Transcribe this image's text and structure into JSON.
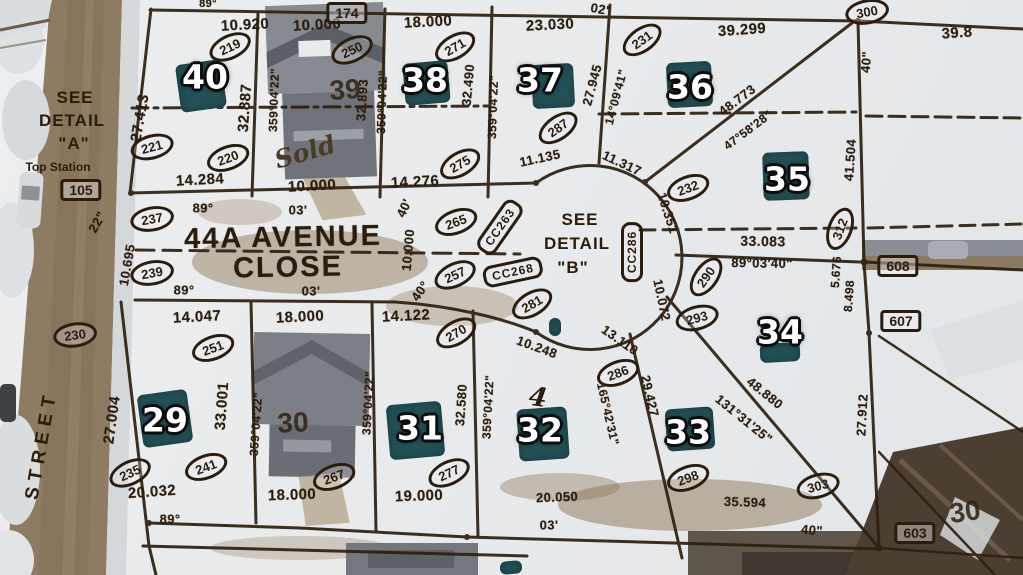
{
  "map_type": "aerial-survey-plat-overlay",
  "ink_color": "#2b1c0c",
  "teal_color": "#235156",
  "street": {
    "main_line1": "44A AVENUE",
    "main_line2": "CLOSE",
    "side_street": "STREET"
  },
  "notes": {
    "detail_a": [
      "SEE",
      "DETAIL",
      "\"A\""
    ],
    "detail_a_sub": "Top Station",
    "detail_b": [
      "SEE",
      "DETAIL",
      "\"B\""
    ],
    "sold": "Sold",
    "pen_mark": "4"
  },
  "lots": {
    "badges": [
      {
        "t": "40",
        "x": 205,
        "y": 77
      },
      {
        "t": "38",
        "x": 425,
        "y": 80
      },
      {
        "t": "37",
        "x": 540,
        "y": 80
      },
      {
        "t": "36",
        "x": 690,
        "y": 87
      },
      {
        "t": "35",
        "x": 787,
        "y": 179
      },
      {
        "t": "34",
        "x": 780,
        "y": 332
      },
      {
        "t": "33",
        "x": 688,
        "y": 432
      },
      {
        "t": "32",
        "x": 540,
        "y": 430
      },
      {
        "t": "31",
        "x": 420,
        "y": 428
      },
      {
        "t": "29",
        "x": 165,
        "y": 420
      }
    ],
    "roof_numbers": [
      {
        "t": "39",
        "x": 345,
        "y": 90,
        "r": -4
      },
      {
        "t": "30",
        "x": 293,
        "y": 423,
        "r": -3
      },
      {
        "t": "30",
        "x": 965,
        "y": 512,
        "r": -8
      }
    ],
    "teal_patches": [
      {
        "x": 178,
        "y": 62,
        "w": 46,
        "h": 48,
        "r": -8
      },
      {
        "x": 404,
        "y": 62,
        "w": 45,
        "h": 42,
        "r": -5
      },
      {
        "x": 532,
        "y": 64,
        "w": 42,
        "h": 44,
        "r": -3
      },
      {
        "x": 667,
        "y": 62,
        "w": 45,
        "h": 45,
        "r": -3
      },
      {
        "x": 763,
        "y": 152,
        "w": 46,
        "h": 48,
        "r": -2
      },
      {
        "x": 760,
        "y": 343,
        "w": 40,
        "h": 19,
        "r": -3
      },
      {
        "x": 666,
        "y": 408,
        "w": 48,
        "h": 42,
        "r": -4
      },
      {
        "x": 518,
        "y": 408,
        "w": 50,
        "h": 52,
        "r": -4
      },
      {
        "x": 388,
        "y": 403,
        "w": 55,
        "h": 55,
        "r": -5
      },
      {
        "x": 140,
        "y": 392,
        "w": 50,
        "h": 53,
        "r": -8
      },
      {
        "x": 549,
        "y": 318,
        "w": 12,
        "h": 18,
        "r": 0
      },
      {
        "x": 500,
        "y": 561,
        "w": 22,
        "h": 13,
        "r": -5
      }
    ]
  },
  "annotations": {
    "dimensions": [
      {
        "t": "89°",
        "x": 208,
        "y": 4,
        "s": 11
      },
      {
        "t": "10.920",
        "x": 245,
        "y": 25,
        "r": -3
      },
      {
        "t": "10.000",
        "x": 317,
        "y": 25,
        "r": -3
      },
      {
        "t": "18.000",
        "x": 428,
        "y": 22,
        "r": -3
      },
      {
        "t": "23.030",
        "x": 550,
        "y": 25,
        "r": -3
      },
      {
        "t": "02'",
        "x": 600,
        "y": 9,
        "r": 10,
        "s": 13
      },
      {
        "t": "39.299",
        "x": 742,
        "y": 30,
        "r": -4
      },
      {
        "t": "39.8",
        "x": 957,
        "y": 33,
        "r": -4
      },
      {
        "t": "27.413",
        "x": 140,
        "y": 118,
        "r": -80
      },
      {
        "t": "32.887",
        "x": 245,
        "y": 108,
        "r": -86
      },
      {
        "t": "359°04'22\"",
        "x": 274,
        "y": 100,
        "r": -88,
        "s": 12
      },
      {
        "t": "32.893",
        "x": 362,
        "y": 100,
        "r": -86,
        "s": 13
      },
      {
        "t": "359°04'22\"",
        "x": 382,
        "y": 102,
        "r": -88,
        "s": 12
      },
      {
        "t": "32.490",
        "x": 468,
        "y": 85,
        "r": -85,
        "s": 13
      },
      {
        "t": "359°04'22\"",
        "x": 493,
        "y": 107,
        "r": -88,
        "s": 12
      },
      {
        "t": "27.945",
        "x": 592,
        "y": 85,
        "r": -75,
        "s": 13
      },
      {
        "t": "14°09'41\"",
        "x": 616,
        "y": 97,
        "r": -75,
        "s": 12
      },
      {
        "t": "48.773",
        "x": 737,
        "y": 100,
        "r": -37,
        "s": 13
      },
      {
        "t": "47°58'28\"",
        "x": 748,
        "y": 130,
        "r": -37,
        "s": 12
      },
      {
        "t": "40\"",
        "x": 866,
        "y": 62,
        "r": -85,
        "s": 13
      },
      {
        "t": "41.504",
        "x": 850,
        "y": 160,
        "r": -86,
        "s": 13
      },
      {
        "t": "11.135",
        "x": 540,
        "y": 158,
        "r": -12,
        "s": 13
      },
      {
        "t": "11.317",
        "x": 622,
        "y": 163,
        "r": 25,
        "s": 13
      },
      {
        "t": "14.284",
        "x": 200,
        "y": 180,
        "r": -3
      },
      {
        "t": "10.000",
        "x": 312,
        "y": 186,
        "r": -3
      },
      {
        "t": "14.276",
        "x": 415,
        "y": 182,
        "r": -3
      },
      {
        "t": "89°",
        "x": 203,
        "y": 208,
        "s": 13
      },
      {
        "t": "03'",
        "x": 298,
        "y": 210,
        "s": 13
      },
      {
        "t": "40'",
        "x": 404,
        "y": 208,
        "r": -65,
        "s": 13
      },
      {
        "t": "10.000",
        "x": 408,
        "y": 250,
        "r": -85,
        "s": 13
      },
      {
        "t": "40°",
        "x": 420,
        "y": 291,
        "r": -55,
        "s": 13
      },
      {
        "t": "89°",
        "x": 184,
        "y": 290,
        "s": 13
      },
      {
        "t": "03'",
        "x": 311,
        "y": 291,
        "s": 13
      },
      {
        "t": "10.695",
        "x": 127,
        "y": 265,
        "r": -80,
        "s": 13
      },
      {
        "t": "22\"",
        "x": 97,
        "y": 222,
        "r": -60,
        "s": 13
      },
      {
        "t": "10.351",
        "x": 668,
        "y": 213,
        "r": 72,
        "s": 13
      },
      {
        "t": "33.083",
        "x": 763,
        "y": 241,
        "r": 1,
        "s": 14
      },
      {
        "t": "89°03'40\"",
        "x": 762,
        "y": 263,
        "r": 1,
        "s": 13
      },
      {
        "t": "10.072",
        "x": 662,
        "y": 300,
        "r": 78,
        "s": 13
      },
      {
        "t": "5.676",
        "x": 836,
        "y": 272,
        "r": -86,
        "s": 12
      },
      {
        "t": "8.498",
        "x": 849,
        "y": 296,
        "r": -86,
        "s": 12
      },
      {
        "t": "10.248",
        "x": 537,
        "y": 347,
        "r": 20,
        "s": 13
      },
      {
        "t": "13.110",
        "x": 620,
        "y": 340,
        "r": 35,
        "s": 13
      },
      {
        "t": "29.427",
        "x": 650,
        "y": 396,
        "r": 77,
        "s": 13
      },
      {
        "t": "165°42'31\"",
        "x": 608,
        "y": 414,
        "r": 77,
        "s": 12
      },
      {
        "t": "48.880",
        "x": 765,
        "y": 393,
        "r": 39,
        "s": 13
      },
      {
        "t": "131°31'25\"",
        "x": 744,
        "y": 419,
        "r": 39,
        "s": 13
      },
      {
        "t": "27.912",
        "x": 862,
        "y": 415,
        "r": -87,
        "s": 13
      },
      {
        "t": "35.594",
        "x": 745,
        "y": 502,
        "r": 2,
        "s": 13
      },
      {
        "t": "40\"",
        "x": 812,
        "y": 530,
        "r": 5,
        "s": 13
      },
      {
        "t": "20.050",
        "x": 557,
        "y": 497,
        "r": -2,
        "s": 13
      },
      {
        "t": "03'",
        "x": 549,
        "y": 525,
        "s": 13
      },
      {
        "t": "14.047",
        "x": 197,
        "y": 317,
        "r": -3
      },
      {
        "t": "18.000",
        "x": 300,
        "y": 317,
        "r": -3
      },
      {
        "t": "14.122",
        "x": 406,
        "y": 316,
        "r": -3
      },
      {
        "t": "27.004",
        "x": 112,
        "y": 420,
        "r": -82
      },
      {
        "t": "33.001",
        "x": 222,
        "y": 406,
        "r": -86
      },
      {
        "t": "359°04'22\"",
        "x": 256,
        "y": 424,
        "r": -86,
        "s": 12
      },
      {
        "t": "359°04'22\"",
        "x": 368,
        "y": 403,
        "r": -87,
        "s": 12
      },
      {
        "t": "32.580",
        "x": 461,
        "y": 405,
        "r": -86,
        "s": 13
      },
      {
        "t": "359°04'22\"",
        "x": 488,
        "y": 407,
        "r": -87,
        "s": 12
      },
      {
        "t": "20.032",
        "x": 152,
        "y": 492,
        "r": -4
      },
      {
        "t": "89°",
        "x": 170,
        "y": 519,
        "s": 13
      },
      {
        "t": "18.000",
        "x": 292,
        "y": 495,
        "r": -2
      },
      {
        "t": "19.000",
        "x": 419,
        "y": 496,
        "r": -2
      }
    ],
    "circled_points": [
      {
        "t": "219",
        "x": 230,
        "y": 47,
        "r": -25
      },
      {
        "t": "221",
        "x": 152,
        "y": 147,
        "r": -15
      },
      {
        "t": "220",
        "x": 228,
        "y": 158,
        "r": -20
      },
      {
        "t": "250",
        "x": 352,
        "y": 50,
        "r": -25
      },
      {
        "t": "271",
        "x": 455,
        "y": 47,
        "r": -30
      },
      {
        "t": "231",
        "x": 642,
        "y": 40,
        "r": -35
      },
      {
        "t": "300",
        "x": 867,
        "y": 12,
        "r": -10
      },
      {
        "t": "287",
        "x": 558,
        "y": 128,
        "r": -35
      },
      {
        "t": "275",
        "x": 460,
        "y": 164,
        "r": -30
      },
      {
        "t": "232",
        "x": 688,
        "y": 188,
        "r": -20
      },
      {
        "t": "312",
        "x": 840,
        "y": 229,
        "r": -70
      },
      {
        "t": "290",
        "x": 706,
        "y": 277,
        "r": -55
      },
      {
        "t": "293",
        "x": 697,
        "y": 318,
        "r": -15
      },
      {
        "t": "286",
        "x": 618,
        "y": 373,
        "r": -20
      },
      {
        "t": "265",
        "x": 456,
        "y": 222,
        "r": -20
      },
      {
        "t": "257",
        "x": 455,
        "y": 275,
        "r": -25
      },
      {
        "t": "281",
        "x": 532,
        "y": 304,
        "r": -30
      },
      {
        "t": "270",
        "x": 456,
        "y": 333,
        "r": -30
      },
      {
        "t": "237",
        "x": 152,
        "y": 219,
        "r": -10
      },
      {
        "t": "239",
        "x": 152,
        "y": 273,
        "r": -10
      },
      {
        "t": "230",
        "x": 75,
        "y": 335,
        "r": -8
      },
      {
        "t": "251",
        "x": 213,
        "y": 348,
        "r": -20
      },
      {
        "t": "241",
        "x": 206,
        "y": 467,
        "r": -20
      },
      {
        "t": "235",
        "x": 130,
        "y": 473,
        "r": -25
      },
      {
        "t": "267",
        "x": 334,
        "y": 477,
        "r": -20
      },
      {
        "t": "277",
        "x": 449,
        "y": 473,
        "r": -25
      },
      {
        "t": "298",
        "x": 688,
        "y": 478,
        "r": -20
      },
      {
        "t": "303",
        "x": 818,
        "y": 486,
        "r": -15
      }
    ],
    "boxed_points": [
      {
        "t": "174",
        "x": 347,
        "y": 13
      },
      {
        "t": "105",
        "x": 81,
        "y": 190
      },
      {
        "t": "608",
        "x": 898,
        "y": 266
      },
      {
        "t": "607",
        "x": 901,
        "y": 321
      },
      {
        "t": "603",
        "x": 915,
        "y": 533
      }
    ],
    "tag_points": [
      {
        "t": "CC263",
        "x": 500,
        "y": 227,
        "r": -55
      },
      {
        "t": "CC268",
        "x": 513,
        "y": 272,
        "r": -12
      },
      {
        "t": "CC286",
        "x": 632,
        "y": 252,
        "r": -90
      }
    ]
  }
}
